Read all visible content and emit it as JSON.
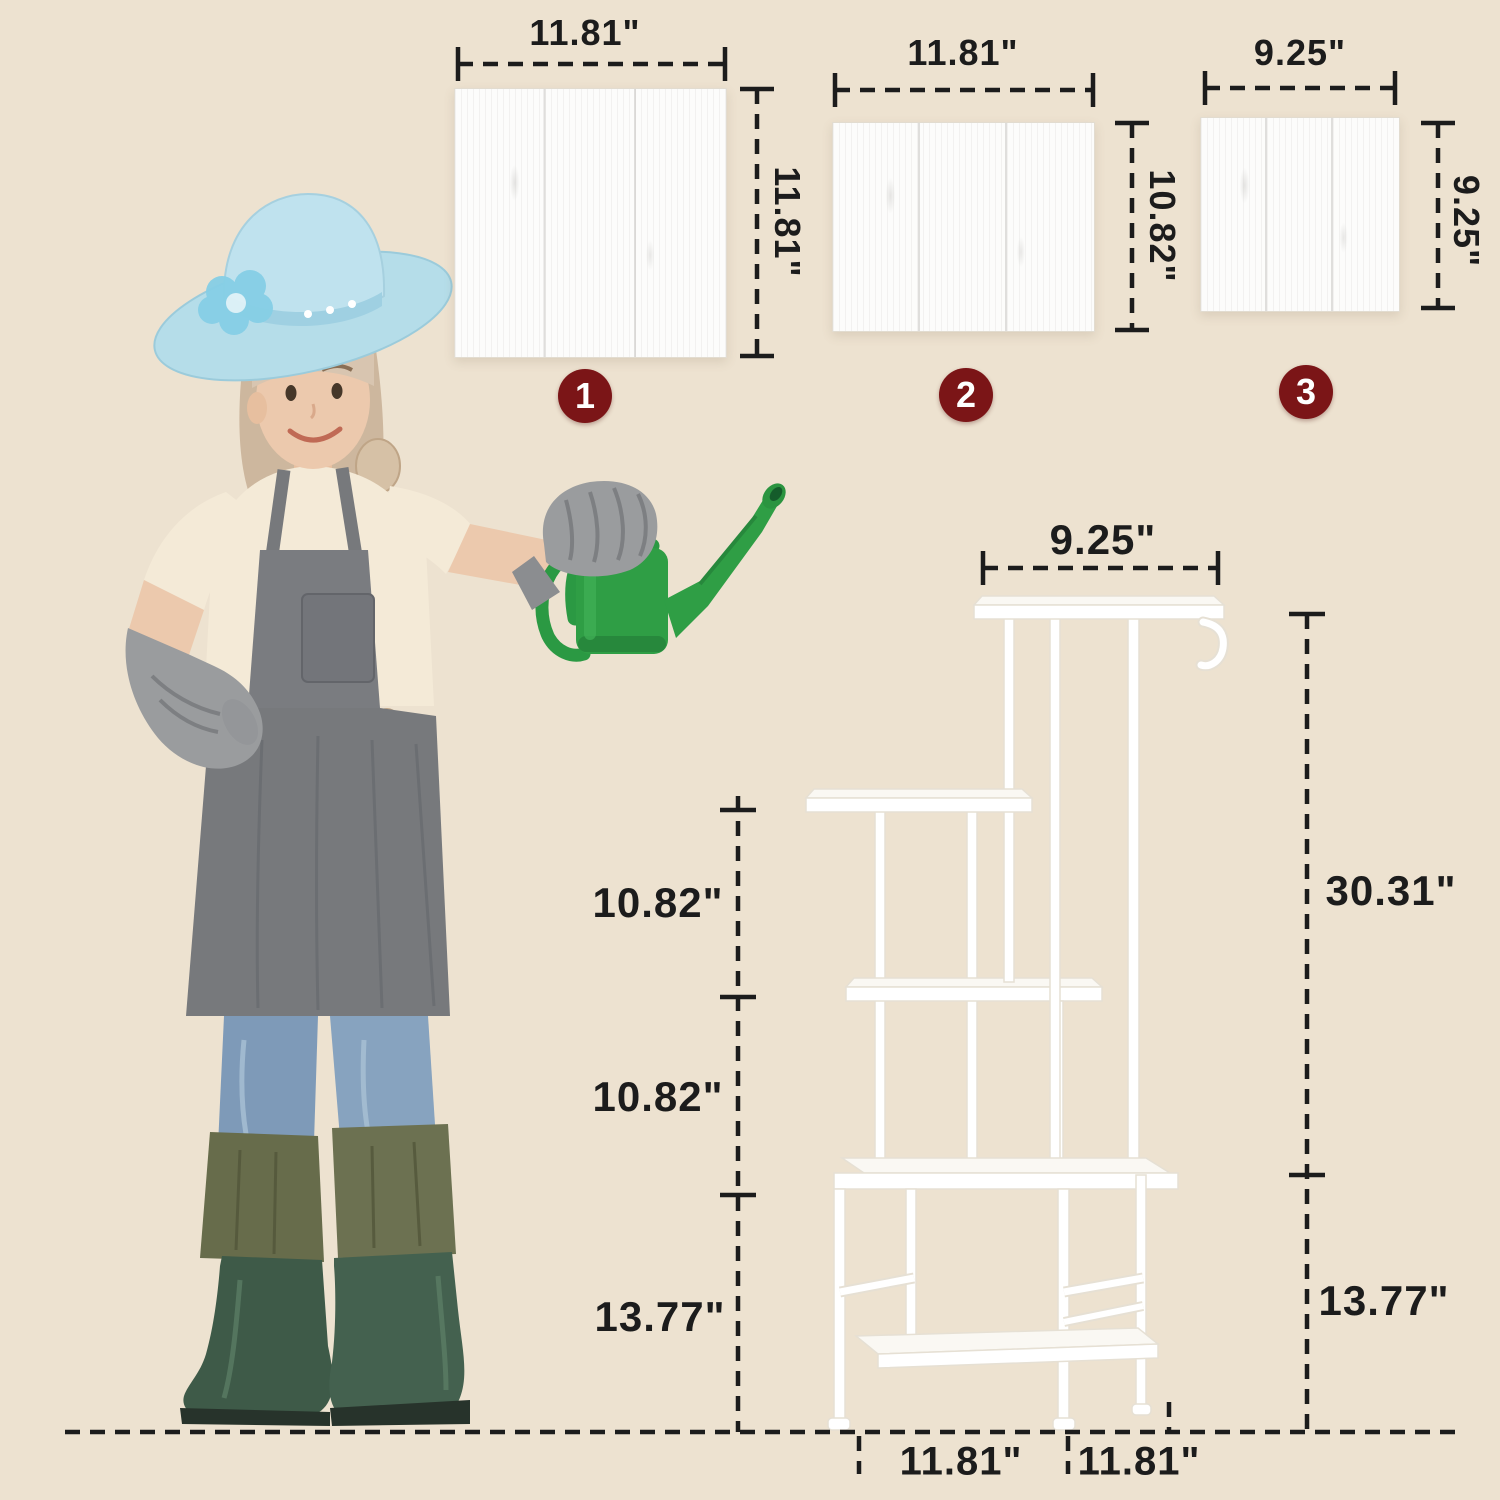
{
  "scene": {
    "type": "product-dimension-diagram",
    "background_color": "#EDE2D0",
    "line_color": "#1C1C1C",
    "badge_color": "#7B1517",
    "badge_text_color": "#FFFFFF",
    "panel_color": "#FCFCFB",
    "stand_color": "#FFFFFF",
    "watering_can_color": "#2F9E45"
  },
  "panels": [
    {
      "badge": "1",
      "width_label": "11.81\"",
      "height_label": "11.81\""
    },
    {
      "badge": "2",
      "width_label": "11.81\"",
      "height_label": "10.82\""
    },
    {
      "badge": "3",
      "width_label": "9.25\"",
      "height_label": "9.25\""
    }
  ],
  "stand": {
    "top_width_label": "9.25\"",
    "upper_height_label": "30.31\"",
    "lower_height_label": "13.77\"",
    "left_segment_labels": [
      "10.82\"",
      "10.82\"",
      "13.77\""
    ],
    "bottom_depth_label": "11.81\"",
    "bottom_width_label": "11.81\""
  }
}
